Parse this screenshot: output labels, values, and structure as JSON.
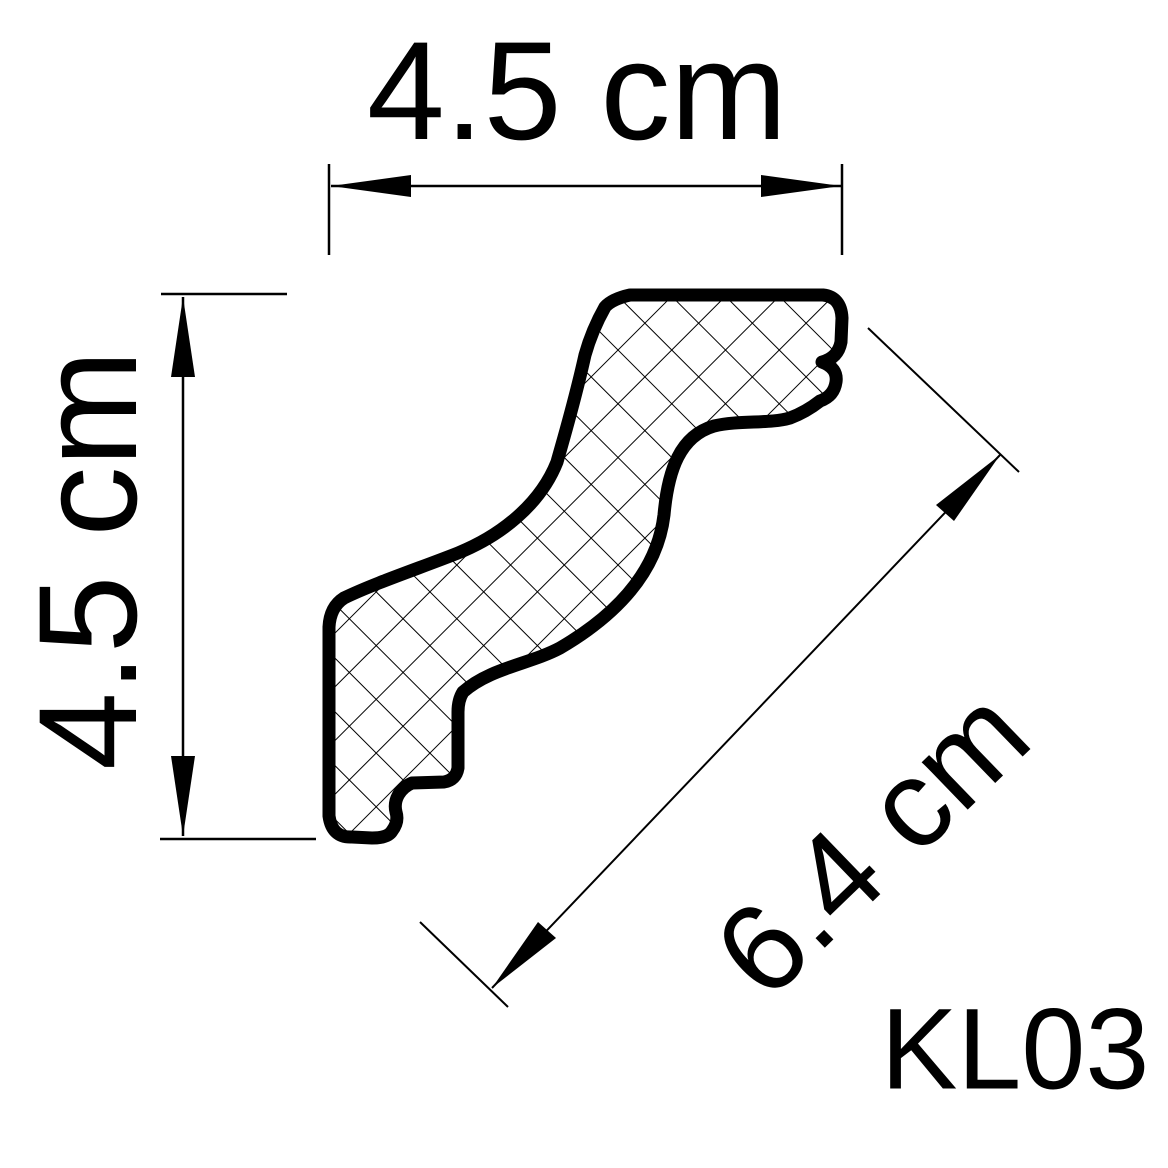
{
  "canvas": {
    "background": "#ffffff",
    "ink": "#000000"
  },
  "drawing": {
    "type": "profile-cross-section",
    "product_code": "KL03",
    "fill_pattern": "crosshatch",
    "dimensions": {
      "width": {
        "label": "4.5 cm",
        "value": 4.5,
        "unit": "cm",
        "orientation": "horizontal"
      },
      "height": {
        "label": "4.5 cm",
        "value": 4.5,
        "unit": "cm",
        "orientation": "vertical"
      },
      "diagonal": {
        "label": "6.4 cm",
        "value": 6.4,
        "unit": "cm",
        "orientation": "diagonal"
      }
    }
  }
}
